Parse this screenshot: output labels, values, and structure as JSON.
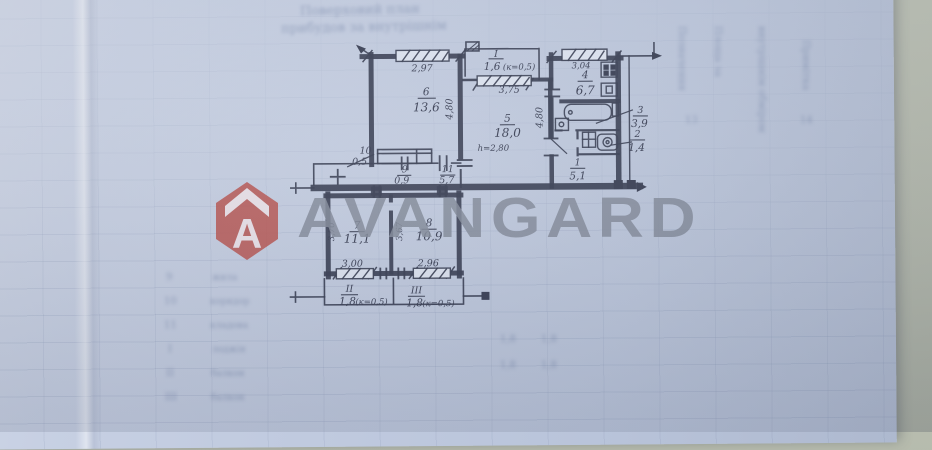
{
  "watermark": {
    "brand": "AVANGARD",
    "logo_letter": "A"
  },
  "colors": {
    "paper": "#c3cde0",
    "ink": "#2b3147",
    "logo_red": "#b5433a",
    "watermark_gray": "#7c8494",
    "desk": "#b2b7a8"
  },
  "plan": {
    "ceiling_note": "h=2,80",
    "rooms": {
      "r6": {
        "num": "6",
        "area": "13,6"
      },
      "rI": {
        "num": "I",
        "area": "1,6",
        "coef": "(к=0,5)"
      },
      "r5": {
        "num": "5",
        "area": "18,0"
      },
      "r4": {
        "num": "4",
        "area": "6,7"
      },
      "r3": {
        "num": "3",
        "area": "3,9"
      },
      "r2": {
        "num": "2",
        "area": "1,4"
      },
      "r1": {
        "num": "1",
        "area": "5,1"
      },
      "r10": {
        "num": "10",
        "area": "0,5"
      },
      "r9": {
        "num": "9",
        "area": "0,9"
      },
      "r11": {
        "num": "11",
        "area": "5,7"
      },
      "r7": {
        "num": "7",
        "area": "11,1"
      },
      "r8": {
        "num": "8",
        "area": "10,9"
      },
      "rII": {
        "num": "II",
        "area": "1,8",
        "coef": "(к=0,5)"
      },
      "rIII": {
        "num": "III",
        "area": "1,8",
        "coef": "(к=0,5)"
      }
    },
    "dims": {
      "top6": "2,97",
      "side6": "4,80",
      "loggia": "3,75",
      "kitchen": "3,04",
      "mid": "4,80",
      "r7v": "3,70",
      "r7w": "3,00",
      "r8v": "3,67",
      "r8w": "2,96"
    }
  },
  "faint": {
    "top_line1": "Поверховий план",
    "top_line2": "прибудов за внутрішнім",
    "col1": "Позначення",
    "col2": "Площа за",
    "col3": "внутрішнім обміром",
    "col4": "Примітка",
    "cell1": "13",
    "cell2": "14",
    "rows": [
      "9",
      "10",
      "11",
      "I",
      "II",
      "III"
    ],
    "row_words": [
      "жила",
      "коридор",
      "кладова",
      "лоджія",
      "балкон",
      "балкон"
    ],
    "nums": [
      "1,8",
      "1,8",
      "1,8",
      "1,8"
    ]
  }
}
